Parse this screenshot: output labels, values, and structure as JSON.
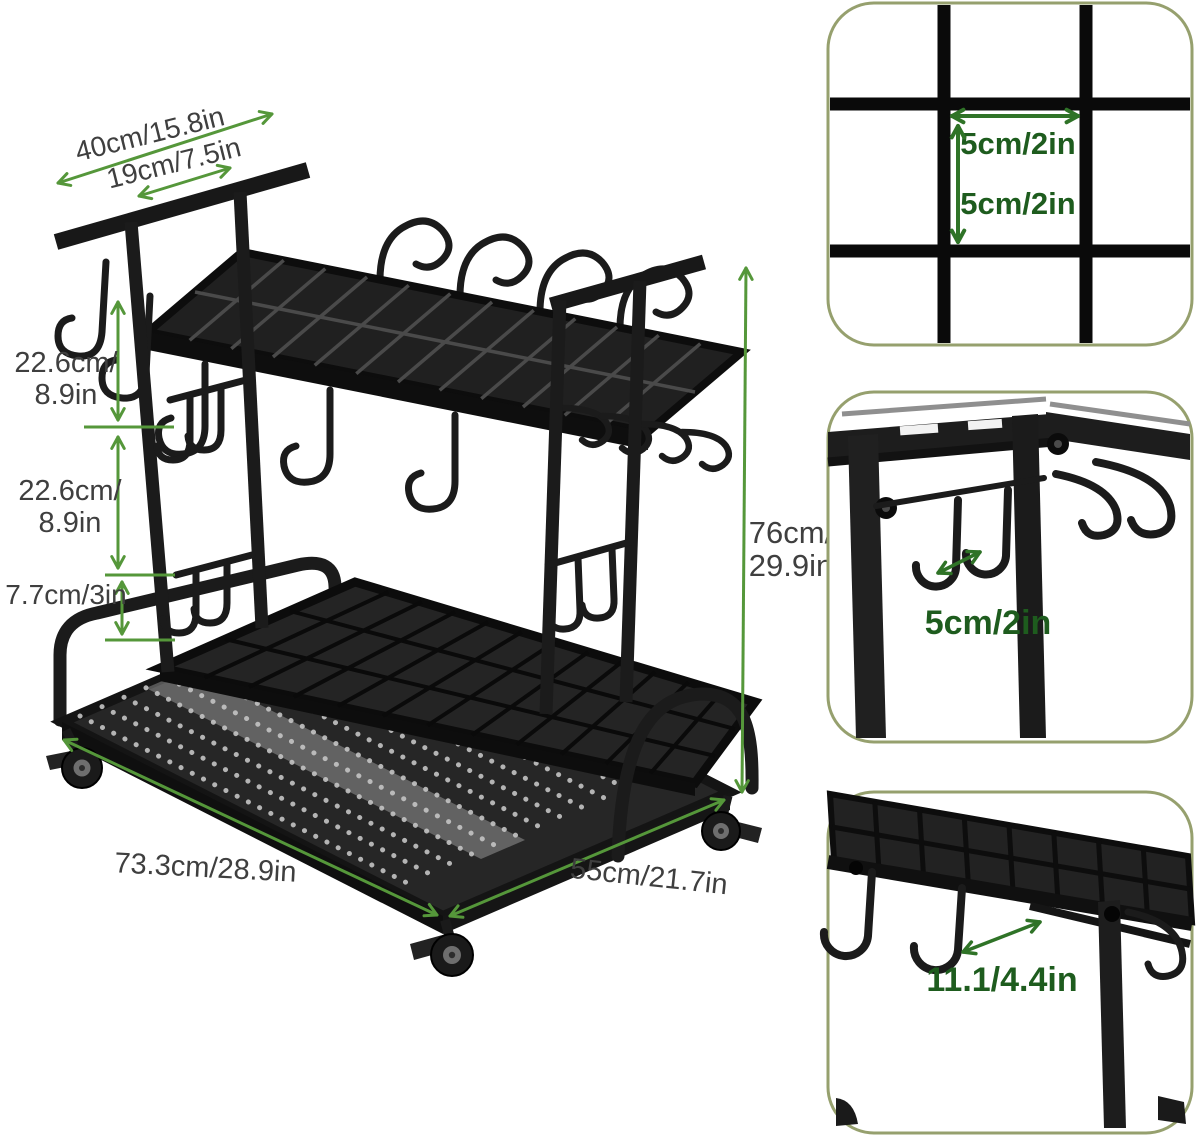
{
  "colors": {
    "background": "#ffffff",
    "dimension_arrow_green": "#55973a",
    "dimension_text_gray": "#3f3f3f",
    "panel_border_olive": "#96a06e",
    "panel_text_green": "#1e5c1e",
    "panel_arrow_green": "#2f7327",
    "rack_black": "#1b1b1b"
  },
  "main_diagram": {
    "dim_top_outer": "40cm/15.8in",
    "dim_top_inner": "19cm/7.5in",
    "dim_upper_l1": "22.6cm/",
    "dim_upper_l2": "8.9in",
    "dim_mid_l1": "22.6cm/",
    "dim_mid_l2": "8.9in",
    "dim_lower": "7.7cm/3in",
    "dim_height_l1": "76cm/",
    "dim_height_l2": "29.9in",
    "dim_length": "73.3cm/28.9in",
    "dim_depth": "55cm/21.7in"
  },
  "panels": {
    "grid_detail": {
      "dim_h": "5cm/2in",
      "dim_v": "5cm/2in"
    },
    "hook_spacing_detail": {
      "dim": "5cm/2in"
    },
    "hook_length_detail": {
      "dim": "11.1/4.4in"
    }
  }
}
